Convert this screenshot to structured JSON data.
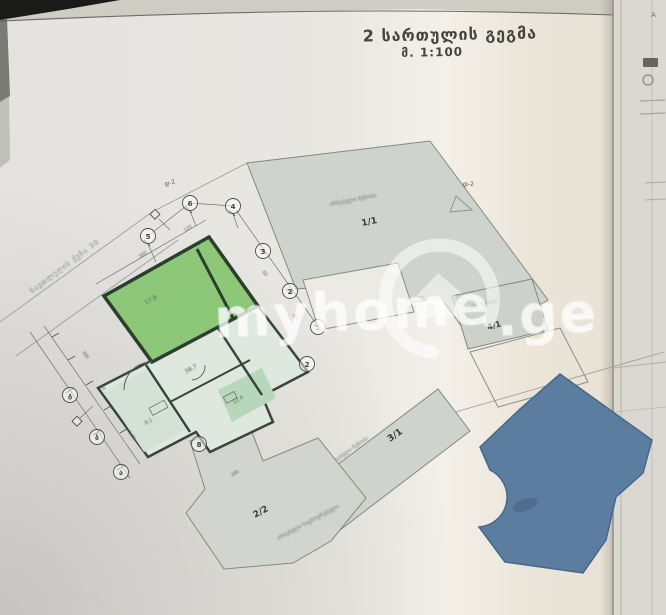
{
  "paper": {
    "title_line1": "2 სართულის გეგმა",
    "title_line2": "მ. 1:100",
    "street_label": "ნავთლუღის ქუჩა 30",
    "corner_mark": "A",
    "axis_marker_top": "დ-2",
    "axis_marker_right": "დ-2"
  },
  "watermark": {
    "brand": "myhome",
    "tld": ".ge"
  },
  "buildings": {
    "b11": {
      "id": "1/1",
      "note": "არსებული შენობა"
    },
    "b22": {
      "id": "2/2",
      "note": "არსებული საცხოვრებელი"
    },
    "b31": {
      "id": "3/1",
      "note": "არსებული შენობა"
    },
    "b41": {
      "id": "4/1",
      "note": "არს. შენობა"
    }
  },
  "apartment": {
    "areas": [
      "17.9",
      "38.7",
      "8.1",
      "12.4"
    ]
  },
  "bubbles": [
    {
      "label": "5"
    },
    {
      "label": "6"
    },
    {
      "label": "4"
    },
    {
      "label": "3"
    },
    {
      "label": "2"
    },
    {
      "label": "1"
    },
    {
      "label": "გ"
    },
    {
      "label": "ბ"
    },
    {
      "label": "ა"
    },
    {
      "label": "8"
    },
    {
      "label": "2"
    }
  ],
  "dims": [
    "300",
    "120",
    "60",
    "90",
    "380",
    "90",
    "1.20",
    "300"
  ],
  "colors": {
    "highlight_room": "#8cc878",
    "blue_building": "#5a7da0",
    "plan_gray": "#d1d5cf"
  }
}
